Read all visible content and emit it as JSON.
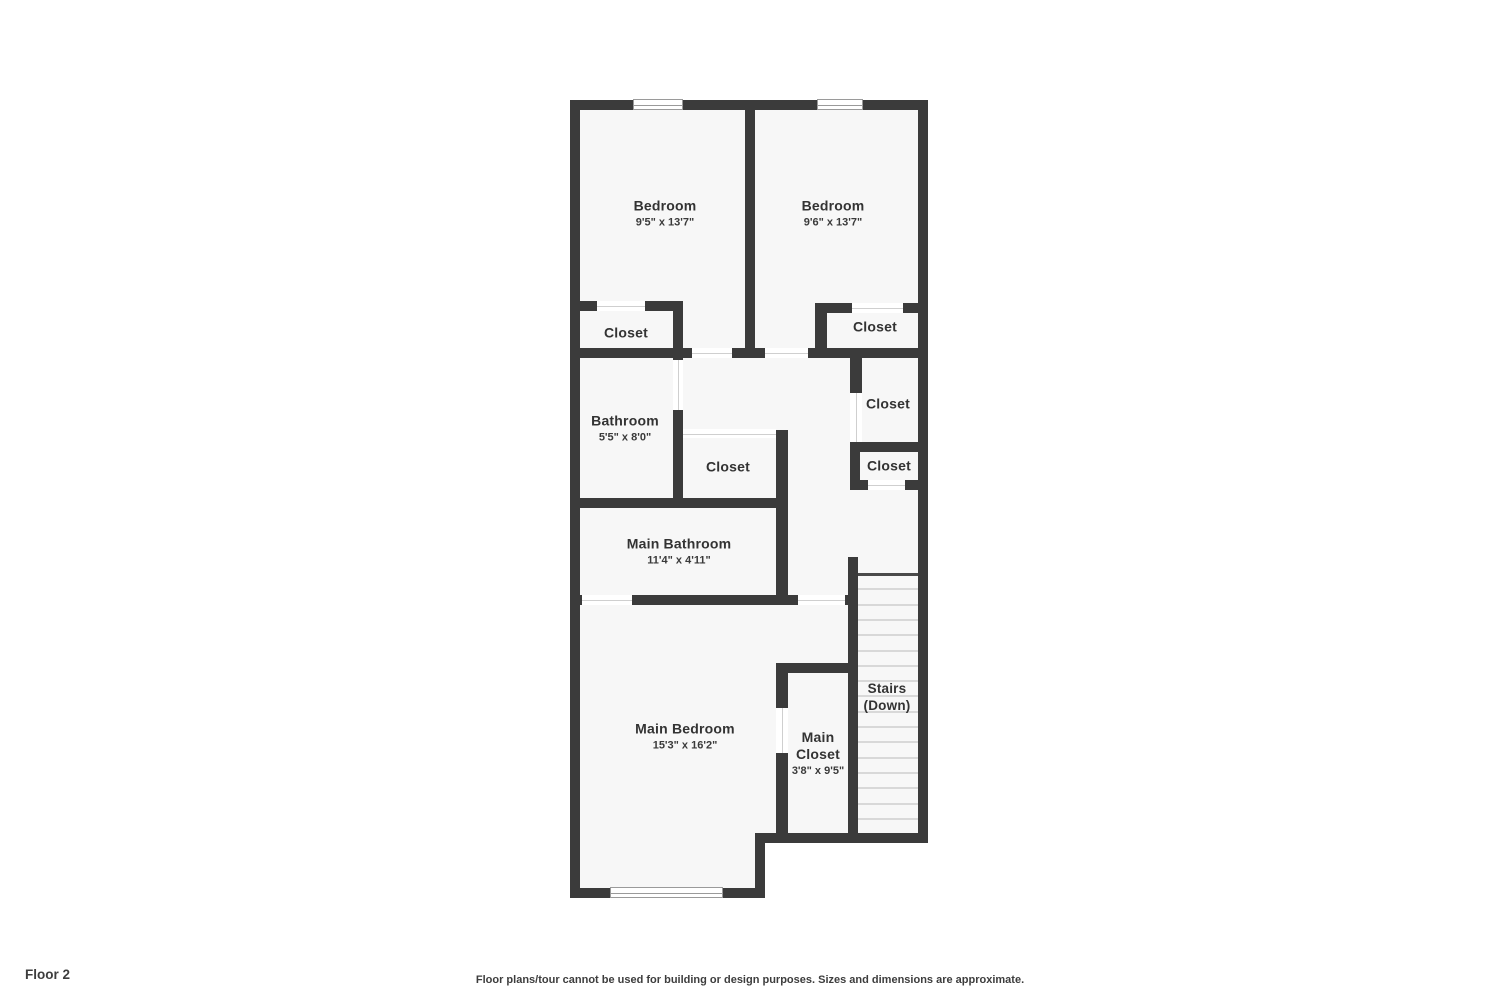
{
  "footer": {
    "floor_label": "Floor 2",
    "disclaimer": "Floor plans/tour cannot be used for building or design purposes. Sizes and dimensions are approximate."
  },
  "colors": {
    "wall": "#3b3b3b",
    "floor": "#f7f7f7",
    "label_text": "#333333",
    "door_threshold": "#cfcfcf",
    "window_frame": "#9a9a9a",
    "stair_tread": "#d8d8d8"
  },
  "rooms": {
    "bedroom_left": {
      "name": "Bedroom",
      "dims": "9'5\" x 13'7\""
    },
    "bedroom_right": {
      "name": "Bedroom",
      "dims": "9'6\" x 13'7\""
    },
    "closet_top_left": {
      "name": "Closet"
    },
    "closet_top_right": {
      "name": "Closet"
    },
    "bathroom": {
      "name": "Bathroom",
      "dims": "5'5\" x 8'0\""
    },
    "closet_center": {
      "name": "Closet"
    },
    "closet_mid_right": {
      "name": "Closet"
    },
    "closet_lower_right": {
      "name": "Closet"
    },
    "main_bathroom": {
      "name": "Main Bathroom",
      "dims": "11'4\" x 4'11\""
    },
    "stairs": {
      "name": "Stairs (Down)"
    },
    "main_bedroom": {
      "name": "Main Bedroom",
      "dims": "15'3\" x 16'2\""
    },
    "main_closet": {
      "name": "Main Closet",
      "dims": "3'8\" x 9'5\""
    }
  }
}
